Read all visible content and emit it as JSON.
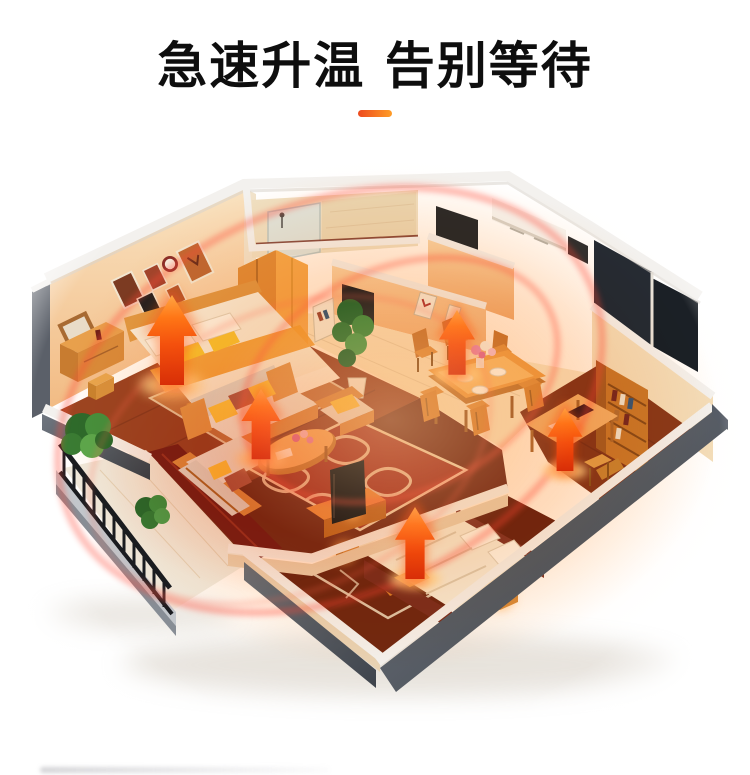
{
  "page": {
    "background_color": "#ffffff"
  },
  "header": {
    "title": "急速升温 告别等待",
    "divider_color_left": "#ed4a1e",
    "divider_color_right": "#ff9d27"
  },
  "illustration": {
    "kind": "isometric-apartment-cutaway-heat-diagram",
    "heat_arrow_count": 5,
    "colors": {
      "arrow_red": "#d83208",
      "arrow_orange": "#ffae4a",
      "heat_ring": "#ff4a38",
      "ambient_glow": "#ff8c3c",
      "outer_wall_gray": "#596068",
      "inner_wall_cream": "#f6dcb4",
      "wood_floor": "#9c4521",
      "furniture_wood": "#e09a42",
      "balcony_rail_black": "#1a1c20",
      "plant_green": "#47913d"
    },
    "rooms": [
      "master-bedroom",
      "bathroom",
      "kitchen",
      "hallway",
      "dining-room",
      "entrance",
      "study",
      "living-room",
      "second-bedroom",
      "balcony"
    ]
  }
}
